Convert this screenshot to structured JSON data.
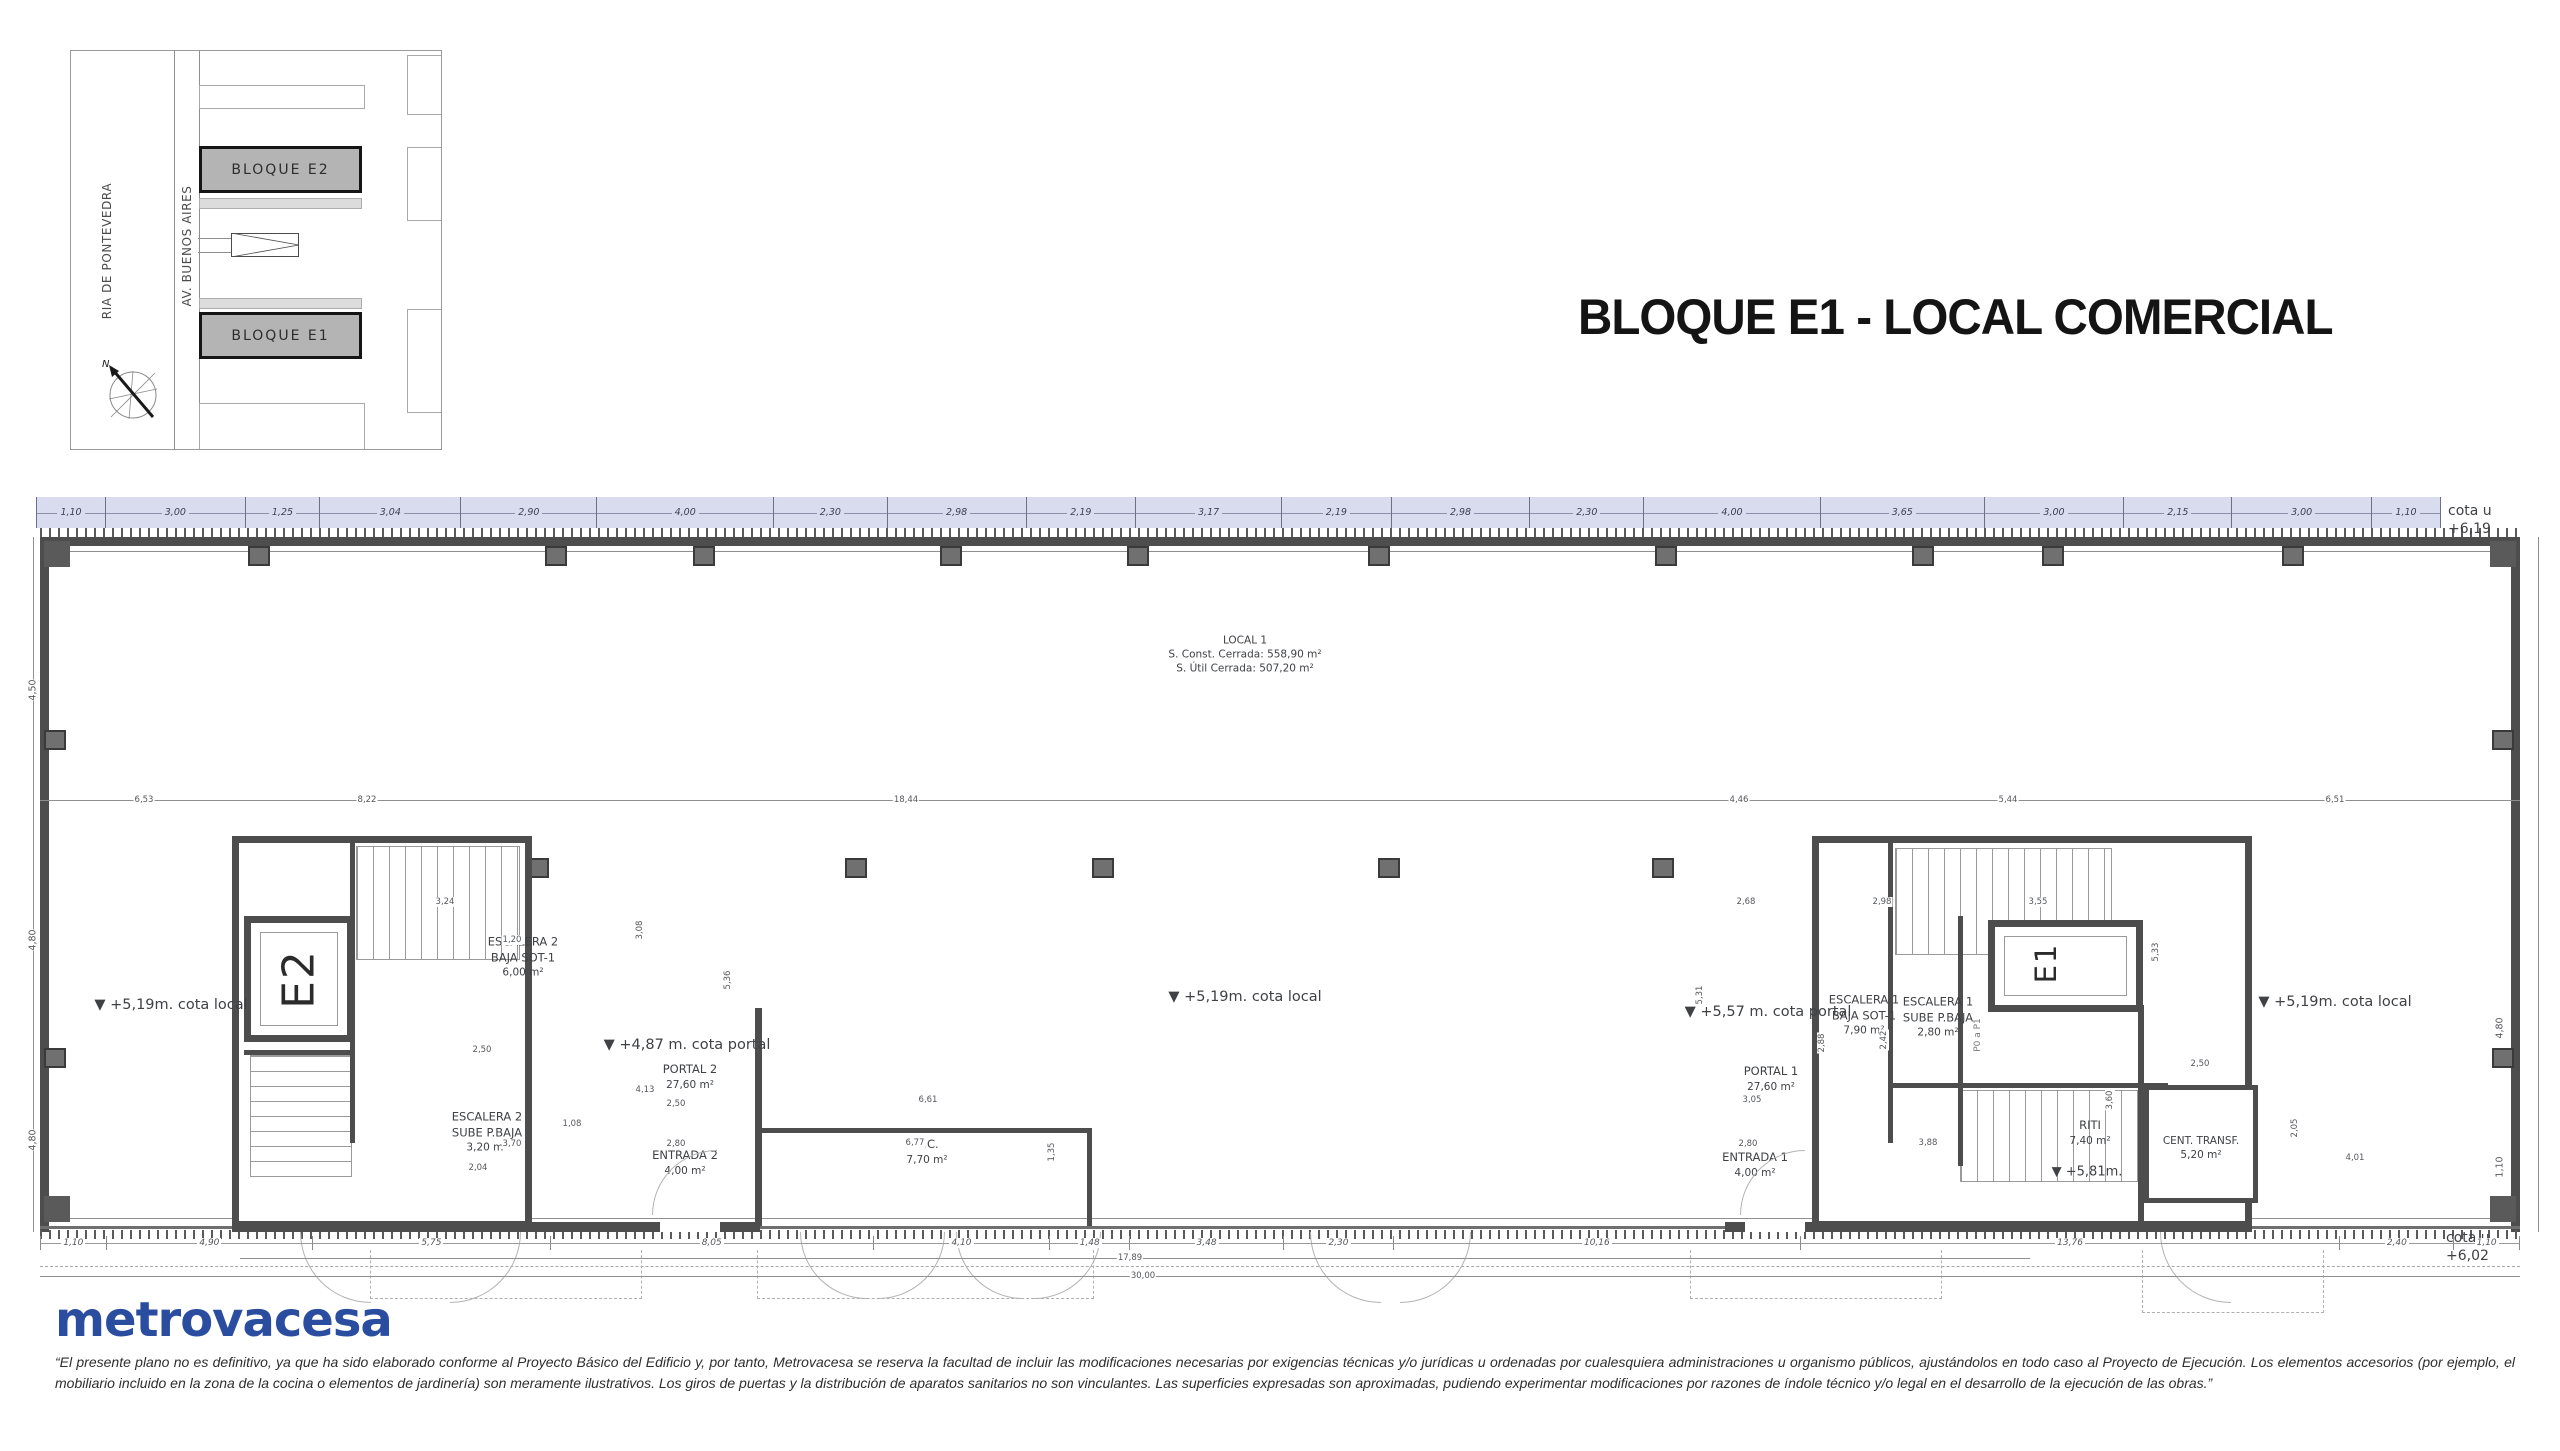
{
  "title": "BLOQUE E1 - LOCAL COMERCIAL",
  "site_map": {
    "street_left": "RIA DE PONTEVEDRA",
    "street_right": "AV. BUENOS AIRES",
    "block_top": "BLOQUE E2",
    "block_bottom": "BLOQUE E1",
    "north": "N"
  },
  "plan": {
    "local": {
      "name": "LOCAL 1",
      "const": "S. Const. Cerrada: 558,90 m²",
      "util": "S. Útil Cerrada: 507,20 m²"
    },
    "cotas": {
      "local": "▼  +5,19m. cota local",
      "portal_2": "▼  +4,87 m. cota portal",
      "portal_1": "▼  +5,57 m. cota portal",
      "riti": "▼ +5,81m.",
      "cota_u": "cota u",
      "cota_u_top": "+6,19",
      "cota_u_bottom": "+6,02"
    },
    "rooms": {
      "elevator_2": "E2",
      "elevator_1": "E1",
      "escalera2_baja": {
        "l1": "ESCALERA 2",
        "l2": "BAJA SOT-1",
        "l3": "6,00 m²"
      },
      "escalera2_sube": {
        "l1": "ESCALERA 2",
        "l2": "SUBE P.BAJA",
        "l3": "3,20 m²"
      },
      "portal2": {
        "l1": "PORTAL 2",
        "l2": "27,60 m²"
      },
      "entrada2": {
        "l1": "ENTRADA 2",
        "l2": "4,00 m²"
      },
      "cc": {
        "l1": "C.C.",
        "l2": "7,70 m²"
      },
      "escalera1_baja": {
        "l1": "ESCALERA 1",
        "l2": "BAJA SOT-1",
        "l3": "7,90 m²"
      },
      "escalera1_sube": {
        "l1": "ESCALERA 1",
        "l2": "SUBE P.BAJA",
        "l3": "2,80 m²"
      },
      "portal1": {
        "l1": "PORTAL 1",
        "l2": "27,60 m²"
      },
      "entrada1": {
        "l1": "ENTRADA 1",
        "l2": "4,00 m²"
      },
      "riti": {
        "l1": "RITI",
        "l2": "7,40 m²"
      },
      "cent_transf": {
        "l1": "CENT. TRANSF.",
        "l2": "5,20 m²"
      },
      "stair_note": "P0 a P1"
    },
    "top_dimensions": [
      "1,10",
      "3,00",
      "1,25",
      "3,04",
      "2,90",
      "4,00",
      "2,30",
      "2,98",
      "2,19",
      "3,17",
      "2,19",
      "2,98",
      "2,30",
      "4,00",
      "3,65",
      "3,00",
      "2,15",
      "3,00",
      "1,10"
    ],
    "mid_dimensions": [
      "6,53",
      "8,22",
      "18,44",
      "4,46",
      "5,44",
      "6,51"
    ],
    "bottom_dimensions": [
      "1,10",
      "4,90",
      "5,75",
      "8,05",
      "4,10",
      "1,48",
      "3,48",
      "2,30",
      "10,16",
      "13,76",
      "2,40",
      "1,10"
    ],
    "overall_dimensions": [
      "17,89",
      "30,00"
    ],
    "left_dimensions": [
      "4,50",
      "4,80",
      "4,80"
    ],
    "right_dimensions": [
      "4,80",
      "1,10"
    ],
    "detail_dims": [
      "3,24",
      "1,20",
      "3,08",
      "5,36",
      "2,50",
      "4,13",
      "2,50",
      "1,08",
      "2,80",
      "2,04",
      "3,70",
      "6,61",
      "6,77",
      "1,35",
      "2,68",
      "2,98",
      "3,55",
      "5,31",
      "2,88",
      "2,42",
      "3,05",
      "2,80",
      "3,88",
      "3,60",
      "5,33",
      "2,50",
      "2,05",
      "4,01"
    ]
  },
  "footer": {
    "logo": "metrovacesa",
    "disclaimer": "“El presente plano no es definitivo, ya que ha sido elaborado conforme al Proyecto Básico del Edificio y, por tanto, Metrovacesa se reserva la facultad de incluir las modificaciones necesarias por exigencias técnicas y/o jurídicas u ordenadas por cualesquiera administraciones u organismo públicos, ajustándolos en todo caso al Proyecto de Ejecución. Los elementos accesorios (por ejemplo, el mobiliario incluido en la zona de la cocina o elementos de jardinería) son meramente ilustrativos. Los giros de puertas y la distribución de aparatos sanitarios no son vinculantes. Las superficies expresadas son aproximadas, pudiendo experimentar modificaciones por razones de índole técnico y/o legal en el desarrollo de la ejecución de las obras.”"
  },
  "colors": {
    "band": "#d9dbee",
    "wall": "#4d4d4d",
    "logo_blue": "#2a4da0"
  }
}
